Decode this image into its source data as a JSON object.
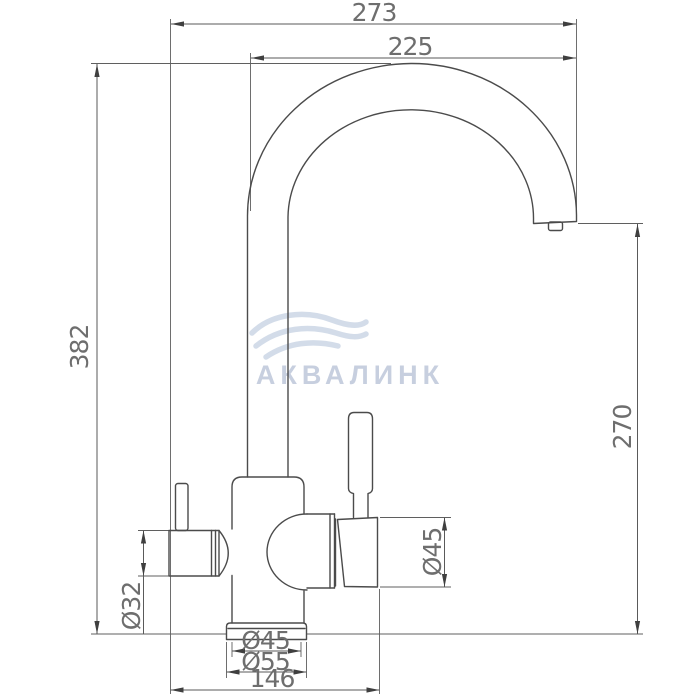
{
  "drawing": {
    "type": "faucet-technical-drawing",
    "watermark": {
      "brand": "АКВАЛИНК"
    },
    "dimensions": {
      "total_width": "273",
      "spout_reach": "225",
      "total_height": "382",
      "spout_outlet_height": "270",
      "left_handle_diameter": "Ø32",
      "right_handle_diameter": "Ø45",
      "body_diameter": "Ø45",
      "base_diameter": "Ø55",
      "handle_span": "146"
    }
  },
  "colors": {
    "line": "#4b4b4b",
    "dimension_line": "#5a5a5a",
    "dimension_text": "#6e6e6e",
    "watermark": "#c7cfdf",
    "background": "#ffffff"
  }
}
